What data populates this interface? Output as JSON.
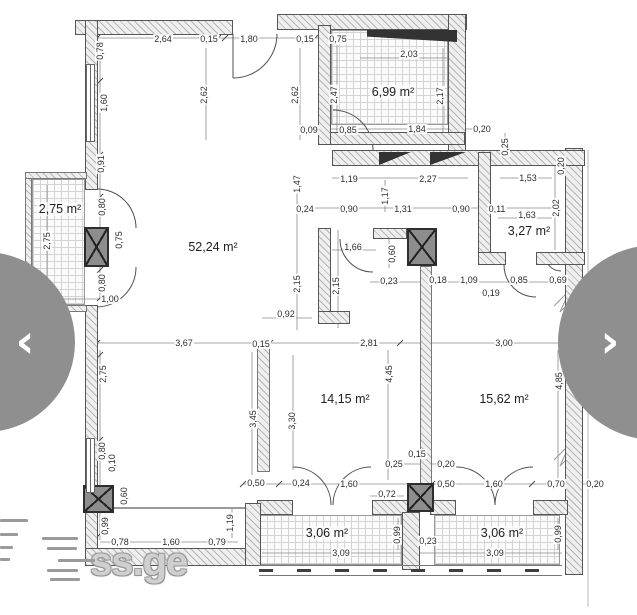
{
  "watermark": {
    "text": "ss.ge"
  },
  "nav": {
    "prev_icon": "‹",
    "next_icon": "›"
  },
  "rooms": [
    {
      "label": "6,99 m²",
      "x": 393,
      "y": 92
    },
    {
      "label": "2,75 m²",
      "x": 60,
      "y": 209
    },
    {
      "label": "52,24 m²",
      "x": 213,
      "y": 247
    },
    {
      "label": "3,27 m²",
      "x": 529,
      "y": 231
    },
    {
      "label": "14,15 m²",
      "x": 345,
      "y": 399
    },
    {
      "label": "15,62 m²",
      "x": 504,
      "y": 399
    },
    {
      "label": "3,06 m²",
      "x": 327,
      "y": 533
    },
    {
      "label": "3,06 m²",
      "x": 502,
      "y": 533
    }
  ],
  "dimensions": [
    {
      "t": "2,64",
      "x": 163,
      "y": 39
    },
    {
      "t": "0,15",
      "x": 209,
      "y": 39
    },
    {
      "t": "1,80",
      "x": 249,
      "y": 39
    },
    {
      "t": "0,15",
      "x": 305,
      "y": 39
    },
    {
      "t": "0,75",
      "x": 338,
      "y": 39
    },
    {
      "t": "0,78",
      "x": 100,
      "y": 51,
      "v": 1
    },
    {
      "t": "1,60",
      "x": 104,
      "y": 103,
      "v": 1
    },
    {
      "t": "0,91",
      "x": 101,
      "y": 164,
      "v": 1
    },
    {
      "t": "0,80",
      "x": 102,
      "y": 207,
      "v": 1
    },
    {
      "t": "0,75",
      "x": 119,
      "y": 240,
      "v": 1
    },
    {
      "t": "0,80",
      "x": 102,
      "y": 283,
      "v": 1
    },
    {
      "t": "2,75",
      "x": 47,
      "y": 241,
      "v": 1
    },
    {
      "t": "1,00",
      "x": 110,
      "y": 299
    },
    {
      "t": "2,62",
      "x": 204,
      "y": 95,
      "v": 1
    },
    {
      "t": "2,62",
      "x": 295,
      "y": 95,
      "v": 1
    },
    {
      "t": "2,47",
      "x": 334,
      "y": 95,
      "v": 1
    },
    {
      "t": "2,03",
      "x": 409,
      "y": 54
    },
    {
      "t": "2,17",
      "x": 440,
      "y": 96,
      "v": 1
    },
    {
      "t": "0,09",
      "x": 309,
      "y": 130
    },
    {
      "t": "0,85",
      "x": 348,
      "y": 130
    },
    {
      "t": "1,84",
      "x": 417,
      "y": 129
    },
    {
      "t": "0,20",
      "x": 482,
      "y": 129
    },
    {
      "t": "1,19",
      "x": 349,
      "y": 179
    },
    {
      "t": "2,27",
      "x": 428,
      "y": 179
    },
    {
      "t": "1,53",
      "x": 528,
      "y": 178
    },
    {
      "t": "1,47",
      "x": 297,
      "y": 184,
      "v": 1
    },
    {
      "t": "1,17",
      "x": 385,
      "y": 196,
      "v": 1
    },
    {
      "t": "0,25",
      "x": 505,
      "y": 147,
      "v": 1
    },
    {
      "t": "0,20",
      "x": 561,
      "y": 166,
      "v": 1
    },
    {
      "t": "0,24",
      "x": 305,
      "y": 209
    },
    {
      "t": "0,90",
      "x": 349,
      "y": 209
    },
    {
      "t": "1,31",
      "x": 403,
      "y": 209
    },
    {
      "t": "0,90",
      "x": 461,
      "y": 209
    },
    {
      "t": "0,11",
      "x": 497,
      "y": 209
    },
    {
      "t": "1,63",
      "x": 527,
      "y": 215
    },
    {
      "t": "2,02",
      "x": 556,
      "y": 208,
      "v": 1
    },
    {
      "t": "1,66",
      "x": 353,
      "y": 247
    },
    {
      "t": "0,60",
      "x": 392,
      "y": 254,
      "v": 1
    },
    {
      "t": "2,15",
      "x": 297,
      "y": 284,
      "v": 1
    },
    {
      "t": "2,15",
      "x": 336,
      "y": 286,
      "v": 1
    },
    {
      "t": "0,23",
      "x": 389,
      "y": 281
    },
    {
      "t": "0,18",
      "x": 438,
      "y": 280
    },
    {
      "t": "1,09",
      "x": 469,
      "y": 280
    },
    {
      "t": "0,19",
      "x": 491,
      "y": 293
    },
    {
      "t": "0,85",
      "x": 519,
      "y": 280
    },
    {
      "t": "0,69",
      "x": 558,
      "y": 280
    },
    {
      "t": "0,92",
      "x": 286,
      "y": 314
    },
    {
      "t": "3,67",
      "x": 184,
      "y": 343
    },
    {
      "t": "0,15",
      "x": 261,
      "y": 344
    },
    {
      "t": "2,81",
      "x": 369,
      "y": 343
    },
    {
      "t": "3,00",
      "x": 504,
      "y": 343
    },
    {
      "t": "2,75",
      "x": 103,
      "y": 374,
      "v": 1
    },
    {
      "t": "3,45",
      "x": 253,
      "y": 419,
      "v": 1
    },
    {
      "t": "3,30",
      "x": 292,
      "y": 421,
      "v": 1
    },
    {
      "t": "4,45",
      "x": 389,
      "y": 374,
      "v": 1
    },
    {
      "t": "4,85",
      "x": 559,
      "y": 381,
      "v": 1
    },
    {
      "t": "0,80",
      "x": 102,
      "y": 451,
      "v": 1
    },
    {
      "t": "0,10",
      "x": 112,
      "y": 463,
      "v": 1
    },
    {
      "t": "0,60",
      "x": 124,
      "y": 496,
      "v": 1
    },
    {
      "t": "0,99",
      "x": 105,
      "y": 526,
      "v": 1
    },
    {
      "t": "0,25",
      "x": 394,
      "y": 464
    },
    {
      "t": "0,15",
      "x": 417,
      "y": 454
    },
    {
      "t": "0,20",
      "x": 446,
      "y": 464
    },
    {
      "t": "0,50",
      "x": 256,
      "y": 483
    },
    {
      "t": "0,24",
      "x": 301,
      "y": 483
    },
    {
      "t": "1,60",
      "x": 349,
      "y": 484
    },
    {
      "t": "0,50",
      "x": 446,
      "y": 484
    },
    {
      "t": "1,60",
      "x": 494,
      "y": 484
    },
    {
      "t": "0,70",
      "x": 556,
      "y": 484
    },
    {
      "t": "0,20",
      "x": 595,
      "y": 484
    },
    {
      "t": "0,72",
      "x": 387,
      "y": 494
    },
    {
      "t": "1,19",
      "x": 230,
      "y": 523,
      "v": 1
    },
    {
      "t": "0,78",
      "x": 120,
      "y": 542
    },
    {
      "t": "1,60",
      "x": 171,
      "y": 542
    },
    {
      "t": "0,79",
      "x": 217,
      "y": 542
    },
    {
      "t": "0,99",
      "x": 397,
      "y": 535,
      "v": 1
    },
    {
      "t": "0,23",
      "x": 428,
      "y": 541
    },
    {
      "t": "0,99",
      "x": 558,
      "y": 534,
      "v": 1
    },
    {
      "t": "3,09",
      "x": 341,
      "y": 553
    },
    {
      "t": "3,09",
      "x": 495,
      "y": 553
    }
  ]
}
